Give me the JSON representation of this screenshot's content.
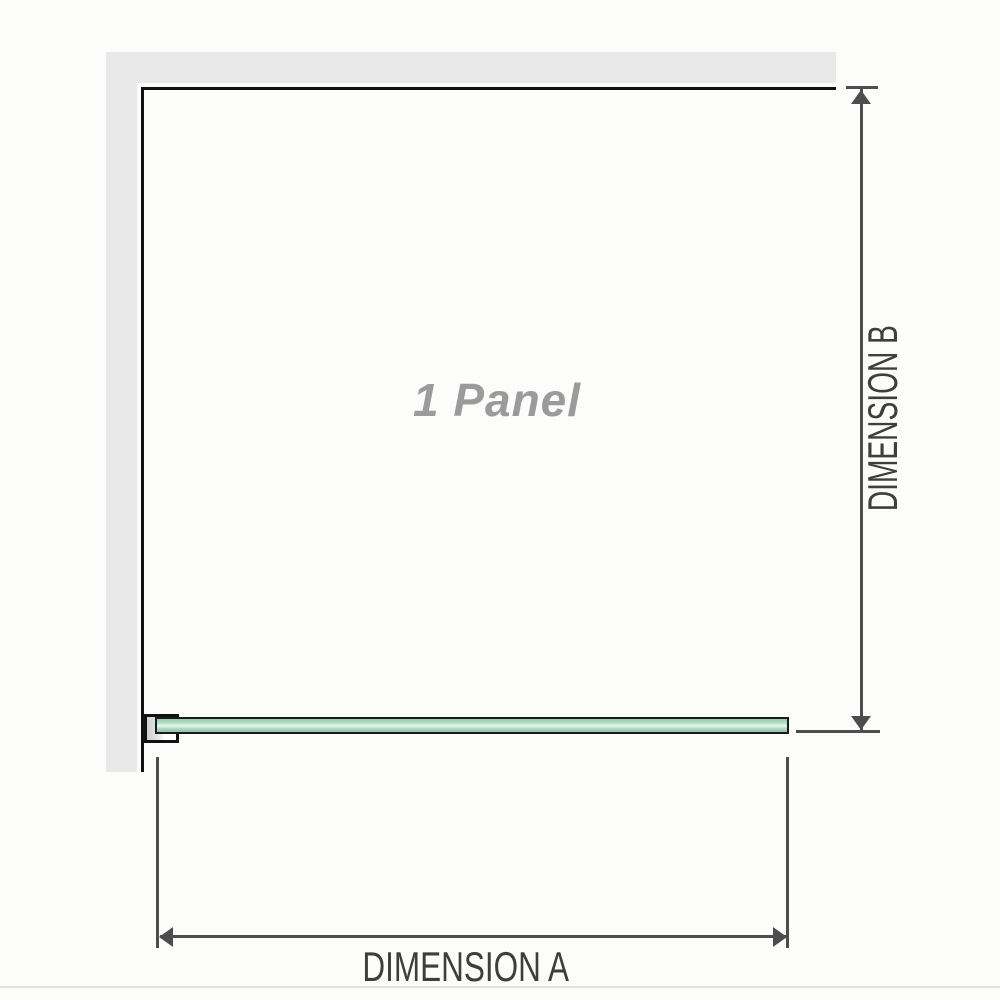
{
  "diagram": {
    "panel_label": "1 Panel",
    "dimension_a": {
      "label": "DIMENSION A"
    },
    "dimension_b": {
      "label": "DIMENSION B"
    }
  },
  "colors": {
    "background": "#fcfcfa",
    "wall_gray": "#e9e9e9",
    "outline_black": "#111111",
    "glass_green": "#a5d6ba",
    "glass_highlight": "#dcf2e5",
    "glass_border": "#1b1b1b",
    "dimension_line_gray": "#4d4d4d",
    "dimension_text_gray": "#3e3e3e",
    "panel_label_gray": "#9b9b9b",
    "footer_line_gray": "#e1e1d9"
  }
}
